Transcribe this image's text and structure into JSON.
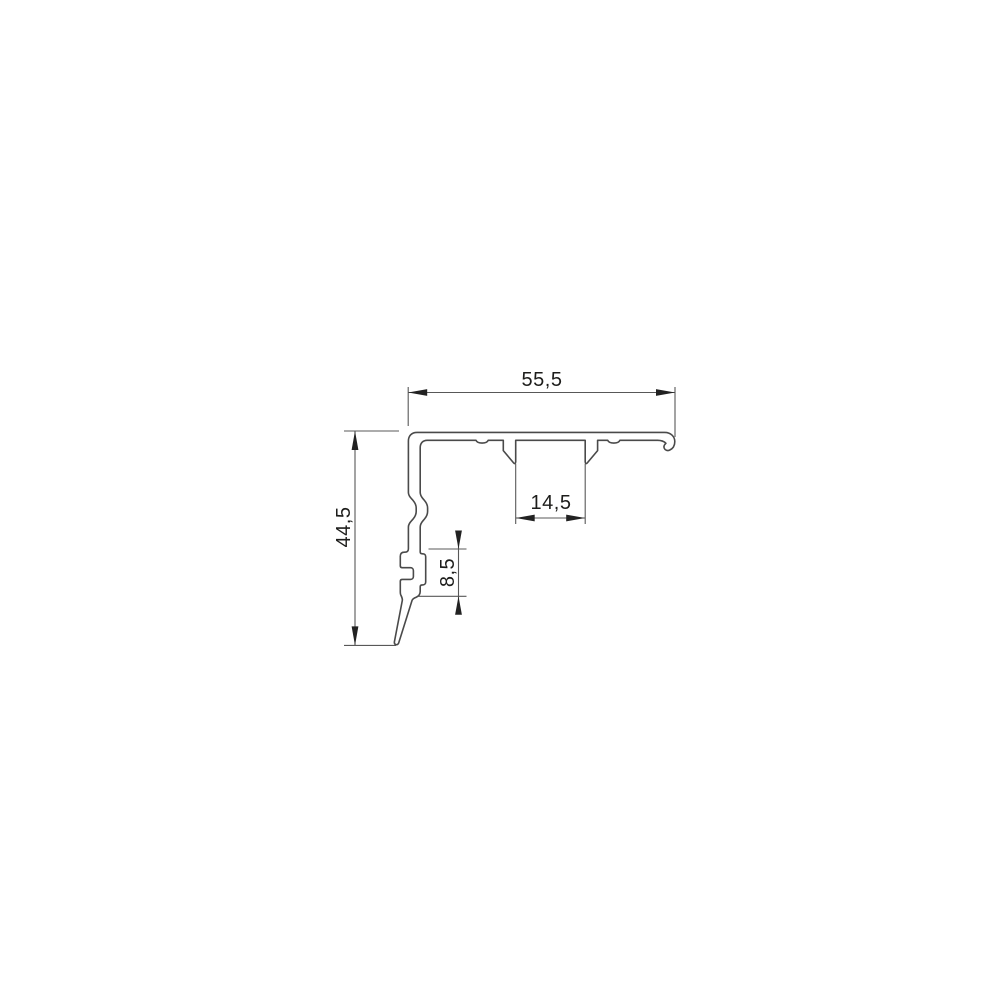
{
  "drawing": {
    "kind": "profile-cross-section-technical-drawing",
    "background": "#ffffff",
    "colors": {
      "outline": "#4a4a4a",
      "dimension_line": "#585858",
      "label_text": "#1d1d1b"
    },
    "dimensions": [
      {
        "id": "overall-width",
        "value": "55,5",
        "orientation": "horizontal"
      },
      {
        "id": "overall-height",
        "value": "44,5",
        "orientation": "vertical"
      },
      {
        "id": "slot-width",
        "value": "14,5",
        "orientation": "horizontal"
      },
      {
        "id": "groove-height",
        "value": "8,5",
        "orientation": "vertical"
      }
    ]
  }
}
